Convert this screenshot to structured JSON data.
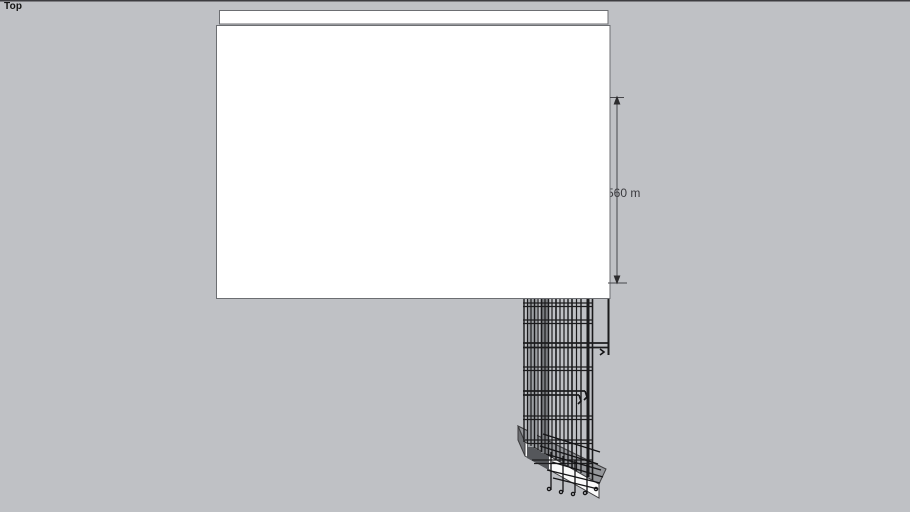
{
  "viewport": {
    "view_label": "Top",
    "background_color": "#bfc1c5"
  },
  "model": {
    "wall": {
      "face_color": "#ffffff",
      "edge_color": "#6c6e72"
    },
    "footing": {
      "top_color": "#95979b",
      "front_color": "#fafafa",
      "end_color": "#6f7175",
      "edge_color": "#3c3c3e"
    },
    "rebar": {
      "color": "#1a1a1c"
    },
    "dimension": {
      "label": "560 m",
      "line_color": "#46464a",
      "text_color": "#3a3a3e"
    }
  }
}
